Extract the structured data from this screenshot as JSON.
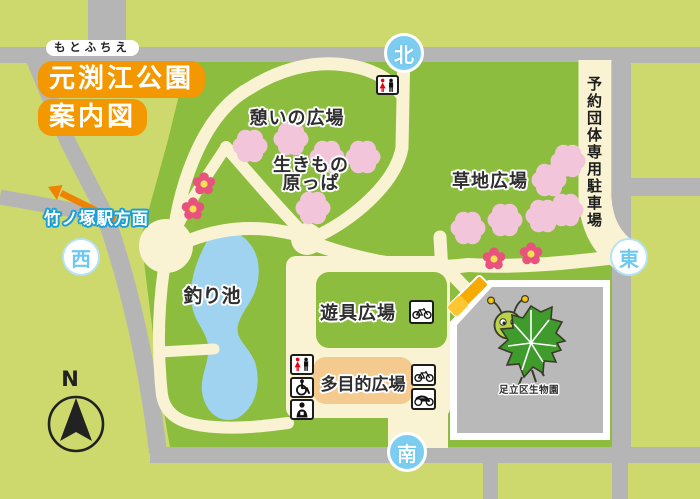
{
  "title": {
    "furigana": "もとふちえ",
    "name": "元渕江公園",
    "subtitle": "案内図"
  },
  "compass": {
    "north_letter": "N"
  },
  "gates": {
    "north": "北",
    "south": "南",
    "east": "東",
    "west": "西"
  },
  "landmarks": {
    "station_direction": "竹ノ塚駅方面",
    "reserved_parking": "予約団体専用駐車場",
    "bio_garden": "足立区生物園"
  },
  "areas": {
    "rest_plaza": "憩いの広場",
    "creature_meadow_line1": "生きもの",
    "creature_meadow_line2": "原っぱ",
    "grass_plaza": "草地広場",
    "fishing_pond": "釣り池",
    "playground_plaza": "遊具広場",
    "multipurpose_plaza": "多目的広場"
  },
  "icons": {
    "toilet_north": "toilet-icon",
    "toilet_plaza": "toilet-icon",
    "wheelchair": "wheelchair-icon",
    "ostomate": "ostomate-icon",
    "bicycle_playground": "bicycle-icon",
    "bicycle_multipurpose": "bicycle-icon",
    "motorcycle": "motorcycle-icon",
    "compass_needle": "north-arrow-icon",
    "cherry_blossom": "cherry-blossom-icon",
    "flower": "azalea-flower-icon",
    "station_arrow": "arrow-northwest-icon",
    "mascot": "caterpillar-leaf-mascot",
    "entrance_gate": "entrance-gate-marker"
  },
  "colors": {
    "park_green": "#8cbd3f",
    "outside_green": "#cdd96d",
    "road_gray": "#b5b5b5",
    "path_cream": "#f9f3d4",
    "pond_blue": "#a0d3f0",
    "title_orange": "#f39800",
    "gate_blue": "#7dcdf0",
    "blossom_pink": "#f2c5da",
    "flower_pink": "#e8537d",
    "flower_center_yellow": "#f6df52",
    "multipurpose_tan": "#f4ca8e",
    "building_gray": "#b9b9b9",
    "arrow_orange": "#ef8200"
  }
}
